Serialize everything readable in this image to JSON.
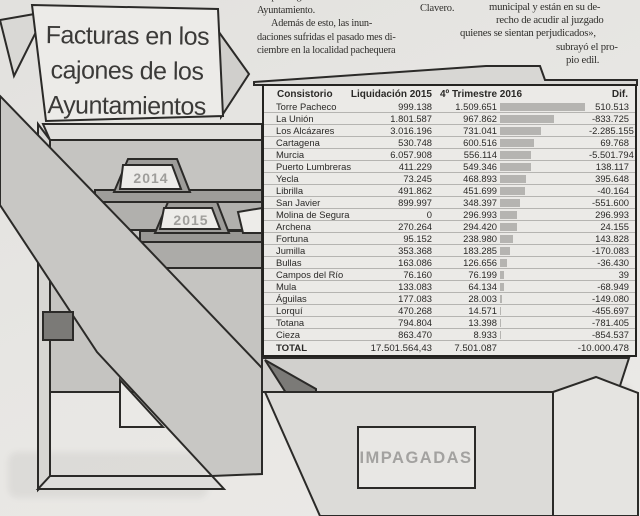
{
  "article": {
    "mid_column": {
      "lines": [
        "del parking subterráneo del",
        "Ayuntamiento.",
        "Además de esto, las inun-",
        "daciones sufridas el pasado mes di-",
        "ciembre en la localidad pachequera"
      ]
    },
    "byline_fragment": "Clavero.",
    "right_column": {
      "lines": [
        "municipal y están en su de-",
        "recho de acudir al juzgado",
        "quienes se sientan perjudicados»,",
        "subrayó el pro-",
        "pio edil."
      ]
    }
  },
  "infographic": {
    "title_lines": [
      "Facturas en los",
      "cajones de los",
      "Ayuntamientos"
    ],
    "folder_tab_2014": "2014",
    "folder_tab_2015": "2015",
    "drawer_stamp": "IMPAGADAS"
  },
  "table": {
    "headers": {
      "consistorio": "Consistorio",
      "liquidacion": "Liquidación 2015",
      "trimestre": "4º Trimestre 2016",
      "dif": "Dif."
    },
    "rows": [
      {
        "name": "Torre Pacheco",
        "liq": "999.138",
        "t4": "1.509.651",
        "dif": "510.513"
      },
      {
        "name": "La Unión",
        "liq": "1.801.587",
        "t4": "967.862",
        "dif": "-833.725"
      },
      {
        "name": "Los Alcázares",
        "liq": "3.016.196",
        "t4": "731.041",
        "dif": "-2.285.155"
      },
      {
        "name": "Cartagena",
        "liq": "530.748",
        "t4": "600.516",
        "dif": "69.768"
      },
      {
        "name": "Murcia",
        "liq": "6.057.908",
        "t4": "556.114",
        "dif": "-5.501.794"
      },
      {
        "name": "Puerto Lumbreras",
        "liq": "411.229",
        "t4": "549.346",
        "dif": "138.117"
      },
      {
        "name": "Yecla",
        "liq": "73.245",
        "t4": "468.893",
        "dif": "395.648"
      },
      {
        "name": "Librilla",
        "liq": "491.862",
        "t4": "451.699",
        "dif": "-40.164"
      },
      {
        "name": "San Javier",
        "liq": "899.997",
        "t4": "348.397",
        "dif": "-551.600"
      },
      {
        "name": "Molina de Segura",
        "liq": "0",
        "t4": "296.993",
        "dif": "296.993"
      },
      {
        "name": "Archena",
        "liq": "270.264",
        "t4": "294.420",
        "dif": "24.155"
      },
      {
        "name": "Fortuna",
        "liq": "95.152",
        "t4": "238.980",
        "dif": "143.828"
      },
      {
        "name": "Jumilla",
        "liq": "353.368",
        "t4": "183.285",
        "dif": "-170.083"
      },
      {
        "name": "Bullas",
        "liq": "163.086",
        "t4": "126.656",
        "dif": "-36.430"
      },
      {
        "name": "Campos del Río",
        "liq": "76.160",
        "t4": "76.199",
        "dif": "39"
      },
      {
        "name": "Mula",
        "liq": "133.083",
        "t4": "64.134",
        "dif": "-68.949"
      },
      {
        "name": "Águilas",
        "liq": "177.083",
        "t4": "28.003",
        "dif": "-149.080"
      },
      {
        "name": "Lorquí",
        "liq": "470.268",
        "t4": "14.571",
        "dif": "-455.697"
      },
      {
        "name": "Totana",
        "liq": "794.804",
        "t4": "13.398",
        "dif": "-781.405"
      },
      {
        "name": "Cieza",
        "liq": "863.470",
        "t4": "8.933",
        "dif": "-854.537"
      }
    ],
    "total": {
      "name": "TOTAL",
      "liq": "17.501.564,43",
      "t4": "7.501.087",
      "dif": "-10.000.478"
    }
  },
  "chart_data": {
    "type": "bar",
    "title": "Facturas en los cajones de los Ayuntamientos",
    "categories": [
      "Torre Pacheco",
      "La Unión",
      "Los Alcázares",
      "Cartagena",
      "Murcia",
      "Puerto Lumbreras",
      "Yecla",
      "Librilla",
      "San Javier",
      "Molina de Segura",
      "Archena",
      "Fortuna",
      "Jumilla",
      "Bullas",
      "Campos del Río",
      "Mula",
      "Águilas",
      "Lorquí",
      "Totana",
      "Cieza"
    ],
    "series": [
      {
        "name": "Liquidación 2015",
        "values": [
          999138,
          1801587,
          3016196,
          530748,
          6057908,
          411229,
          73245,
          491862,
          899997,
          0,
          270264,
          95152,
          353368,
          163086,
          76160,
          133083,
          177083,
          470268,
          794804,
          863470
        ]
      },
      {
        "name": "4º Trimestre 2016",
        "values": [
          1509651,
          967862,
          731041,
          600516,
          556114,
          549346,
          468893,
          451699,
          348397,
          296993,
          294420,
          238980,
          183285,
          126656,
          76199,
          64134,
          28003,
          14571,
          13398,
          8933
        ]
      },
      {
        "name": "Dif.",
        "values": [
          510513,
          -833725,
          -2285155,
          69768,
          -5501794,
          138117,
          395648,
          -40164,
          -551600,
          296993,
          24155,
          143828,
          -170083,
          -36430,
          39,
          -68949,
          -149080,
          -455697,
          -781405,
          -854537
        ]
      }
    ],
    "totals": {
      "liquidacion_2015": 17501564.43,
      "trimestre_4_2016": 7501087,
      "dif": -10000478
    },
    "bars_depict": "4º Trimestre 2016",
    "xlim": [
      0,
      1509651
    ],
    "legend_position": "none",
    "grid": false
  },
  "colors": {
    "paper": "#e7e6e3",
    "ink": "#2a2927",
    "bar": "#b5b4b1",
    "gray_label": "#a09f9c"
  }
}
